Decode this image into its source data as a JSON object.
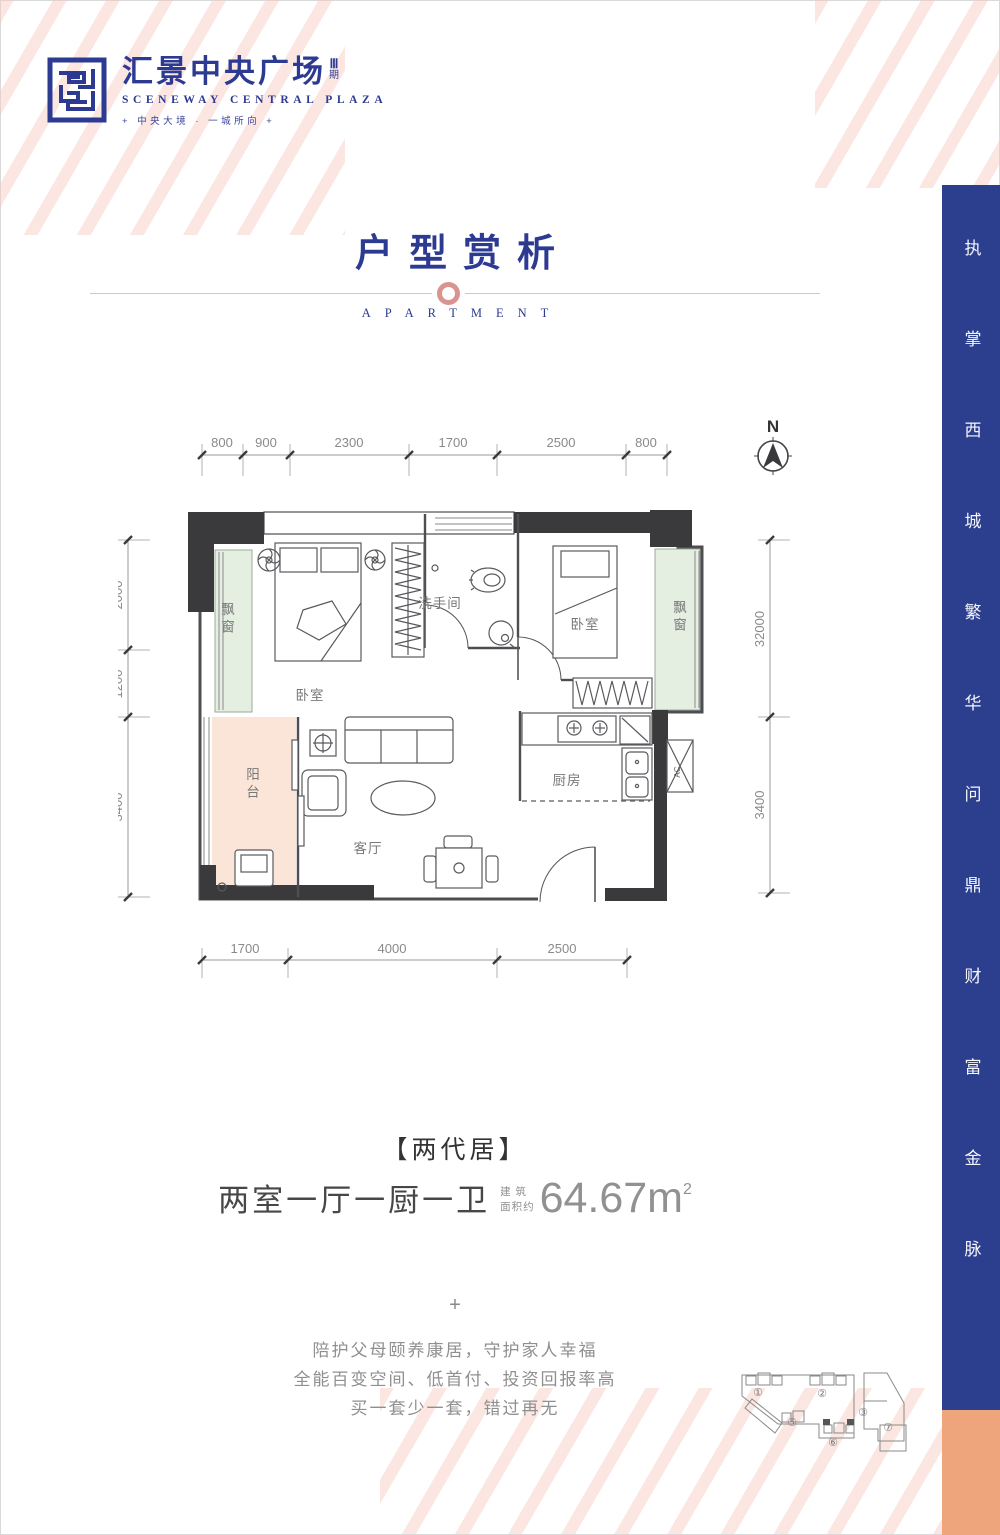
{
  "brand": {
    "name_cn": "汇景中央广场",
    "phase_num": "Ⅲ",
    "phase_unit": "期",
    "name_en": "SCENEWAY CENTRAL PLAZA",
    "tagline": "+  中央大境 · 一城所向  +"
  },
  "section": {
    "title": "户型赏析",
    "subtitle": "APARTMENT"
  },
  "floorplan": {
    "north": "N",
    "labels": {
      "bay_left": "飘窗",
      "bedroom_left": "卧室",
      "bathroom": "洗手间",
      "bedroom_right": "卧室",
      "bay_right": "飘窗",
      "balcony": "阳台",
      "living": "客厅",
      "kitchen": "厨房",
      "ac": "AC"
    },
    "dims_top": [
      "800",
      "900",
      "2300",
      "1700",
      "2500",
      "800"
    ],
    "dims_bottom": [
      "1700",
      "4000",
      "2500"
    ],
    "dims_left": [
      "2000",
      "1200",
      "3400"
    ],
    "dims_right": [
      "32000",
      "3400"
    ]
  },
  "unit": {
    "name": "【两代居】",
    "layout": "两室一厅一厨一卫",
    "area_label_top": "建 筑",
    "area_label_bottom": "面积约",
    "area_value": "64.67m",
    "area_sup": "2"
  },
  "promo": {
    "plus": "+",
    "lines": [
      "陪护父母颐养康居，守护家人幸福",
      "全能百变空间、低首付、投资回报率高",
      "买一套少一套，错过再无"
    ]
  },
  "sidebar": {
    "slogan": "执掌西城繁华问鼎财富金脉"
  },
  "siteplan": {
    "labels": [
      "①",
      "②",
      "③",
      "⑤",
      "⑥",
      "⑦"
    ]
  },
  "colors": {
    "brand_blue": "#2d3a92",
    "sidebar_blue": "#2c3f8f",
    "accent_orange": "#efa57c",
    "stripe_pink": "#f6c7be",
    "ornament_pink": "#d99490",
    "bay_green": "#e4efe2",
    "balcony_peach": "#fbe5d8",
    "wall_dark": "#3a3a3c"
  }
}
